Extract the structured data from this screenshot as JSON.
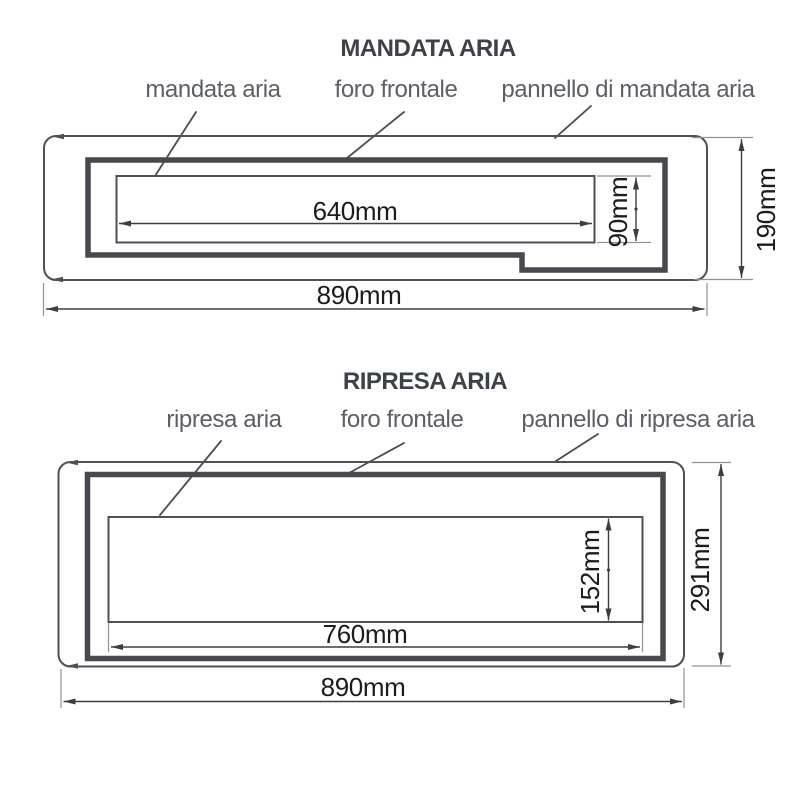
{
  "colors": {
    "background": "#ffffff",
    "title_text": "#3d4248",
    "label_text": "#5c6066",
    "dimension_text": "#1b1c1e",
    "outline": "#4e5156",
    "panel_frame": "#47494e",
    "dimension_line": "#3c3e42",
    "extension_line": "#8f9297"
  },
  "diagrams": [
    {
      "title": "MANDATA ARIA",
      "callouts": [
        {
          "label": "mandata aria"
        },
        {
          "label": "foro frontale"
        },
        {
          "label": "pannello di mandata aria"
        }
      ],
      "dimensions": {
        "hole_width": "640mm",
        "hole_height": "90mm",
        "panel_height": "190mm",
        "panel_width": "890mm"
      }
    },
    {
      "title": "RIPRESA ARIA",
      "callouts": [
        {
          "label": "ripresa aria"
        },
        {
          "label": "foro frontale"
        },
        {
          "label": "pannello di ripresa aria"
        }
      ],
      "dimensions": {
        "hole_width": "760mm",
        "hole_height": "152mm",
        "panel_height": "291mm",
        "panel_width": "890mm"
      }
    }
  ]
}
